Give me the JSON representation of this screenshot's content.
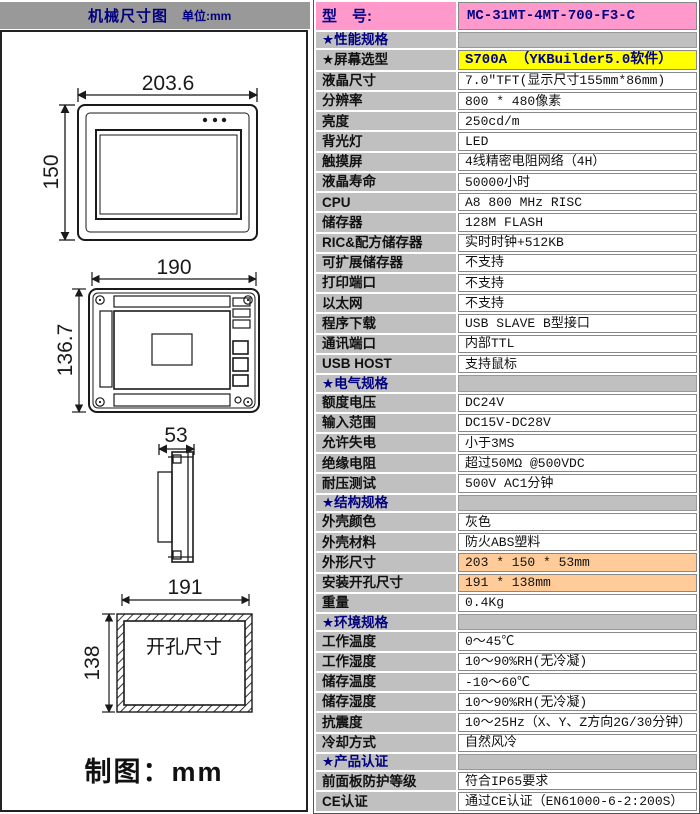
{
  "colors": {
    "header_gray": "#999999",
    "cell_gray": "#C0C0C0",
    "model_pink": "#FF99CC",
    "highlight_yellow": "#FFFF00",
    "highlight_orange": "#FFCC99",
    "section_text_navy": "#000080"
  },
  "left_panel": {
    "header": {
      "title": "机械尺寸图",
      "unit_label": "单位:mm"
    },
    "front_view": {
      "width_dim": "203.6",
      "height_dim": "150"
    },
    "rear_view": {
      "width_dim": "190",
      "height_dim": "136.7"
    },
    "side_view": {
      "depth_dim": "53"
    },
    "cutout_view": {
      "width_dim": "191",
      "height_dim": "138",
      "label": "开孔尺寸"
    },
    "footer": "制图：mm"
  },
  "spec_table": {
    "model_row": {
      "label": "型　号:",
      "value": "MC-31MT-4MT-700-F3-C"
    },
    "rows": [
      {
        "type": "section",
        "label": "★性能规格",
        "value": ""
      },
      {
        "type": "row",
        "label": "★屏幕选型",
        "value": "S700A （YKBuilder5.0软件）",
        "highlight": "yellow"
      },
      {
        "type": "row",
        "label": "液晶尺寸",
        "value": "7.0\"TFT(显示尺寸155mm*86mm)"
      },
      {
        "type": "row",
        "label": "分辨率",
        "value": "800 * 480像素"
      },
      {
        "type": "row",
        "label": "亮度",
        "value": "250cd/m"
      },
      {
        "type": "row",
        "label": "背光灯",
        "value": "LED"
      },
      {
        "type": "row",
        "label": "触摸屏",
        "value": "4线精密电阻网络（4H）"
      },
      {
        "type": "row",
        "label": "液晶寿命",
        "value": "50000小时"
      },
      {
        "type": "row",
        "label": "CPU",
        "value": "A8 800 MHz RISC"
      },
      {
        "type": "row",
        "label": "储存器",
        "value": "128M FLASH"
      },
      {
        "type": "row",
        "label": "RIC&配方储存器",
        "value": "实时时钟+512KB"
      },
      {
        "type": "row",
        "label": "可扩展储存器",
        "value": "不支持"
      },
      {
        "type": "row",
        "label": "打印端口",
        "value": "不支持"
      },
      {
        "type": "row",
        "label": "以太网",
        "value": "不支持"
      },
      {
        "type": "row",
        "label": "程序下载",
        "value": "USB SLAVE B型接口"
      },
      {
        "type": "row",
        "label": "通讯端口",
        "value": "内部TTL"
      },
      {
        "type": "row",
        "label": "USB HOST",
        "value": "支持鼠标"
      },
      {
        "type": "section",
        "label": "★电气规格",
        "value": ""
      },
      {
        "type": "row",
        "label": "额度电压",
        "value": "DC24V"
      },
      {
        "type": "row",
        "label": "输入范围",
        "value": "DC15V-DC28V"
      },
      {
        "type": "row",
        "label": "允许失电",
        "value": "小于3MS"
      },
      {
        "type": "row",
        "label": "绝缘电阻",
        "value": "超过50MΩ @500VDC"
      },
      {
        "type": "row",
        "label": "耐压测试",
        "value": "500V AC1分钟"
      },
      {
        "type": "section",
        "label": "★结构规格",
        "value": ""
      },
      {
        "type": "row",
        "label": "外壳颜色",
        "value": "灰色"
      },
      {
        "type": "row",
        "label": "外壳材料",
        "value": "防火ABS塑料"
      },
      {
        "type": "row",
        "label": "外形尺寸",
        "value": "203 * 150 * 53mm",
        "highlight": "orange"
      },
      {
        "type": "row",
        "label": "安装开孔尺寸",
        "value": "191 * 138mm",
        "highlight": "orange"
      },
      {
        "type": "row",
        "label": "重量",
        "value": "0.4Kg"
      },
      {
        "type": "section",
        "label": "★环境规格",
        "value": ""
      },
      {
        "type": "row",
        "label": "工作温度",
        "value": "0～45℃"
      },
      {
        "type": "row",
        "label": "工作湿度",
        "value": "10～90%RH(无冷凝)"
      },
      {
        "type": "row",
        "label": "储存温度",
        "value": "-10～60℃"
      },
      {
        "type": "row",
        "label": "储存湿度",
        "value": "10～90%RH(无冷凝)"
      },
      {
        "type": "row",
        "label": "抗震度",
        "value": "10～25Hz（X、Y、Z方向2G/30分钟）"
      },
      {
        "type": "row",
        "label": "冷却方式",
        "value": "自然风冷"
      },
      {
        "type": "section",
        "label": "★产品认证",
        "value": ""
      },
      {
        "type": "row",
        "label": "前面板防护等级",
        "value": "符合IP65要求"
      },
      {
        "type": "row",
        "label": "CE认证",
        "value": "通过CE认证（EN61000-6-2:200S）"
      }
    ]
  }
}
